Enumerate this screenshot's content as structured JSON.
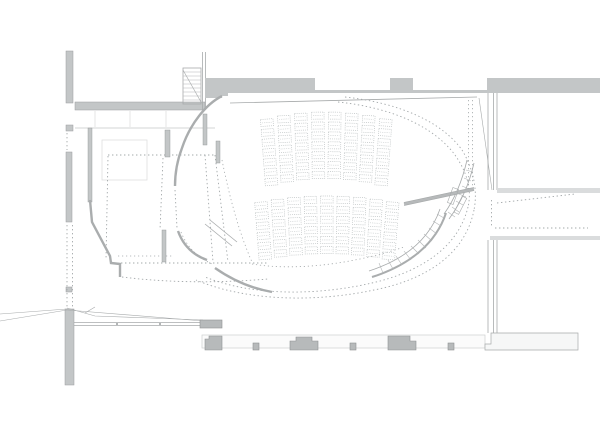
{
  "document": {
    "type": "architectural-floor-plan",
    "subject": "theater-auditorium-plan",
    "visible_text": []
  },
  "canvas": {
    "width": 600,
    "height": 425,
    "background": "#ffffff"
  },
  "colors": {
    "background": "#ffffff",
    "wall_fill": "#c3c6c7",
    "wall_stroke": "#9b9e9f",
    "pier_fill": "#b7babb",
    "pier_stroke": "#8f9293",
    "thick_curve": "#aaadae",
    "thin_line": "#a7aaab",
    "faint_line": "#d9dbdc",
    "dotted_line": "#a3a8aa",
    "seat_line": "#bcc1c2",
    "tread_line": "#b3b6b7",
    "light_band": "#dadcdd"
  },
  "seating": {
    "blocks": [
      {
        "name": "upper-seating-block",
        "rows": 7,
        "cols": 8,
        "seat_count": 56,
        "x0": 263,
        "y0": 112,
        "col_spacing": 16.3,
        "row_spacing": 9.9,
        "seat_w": 12.5,
        "seat_h": 7,
        "arc": 7,
        "fan_deg": 1.2
      },
      {
        "name": "lower-seating-block",
        "rows": 6,
        "cols": 9,
        "seat_count": 54,
        "x0": 257,
        "y0": 196,
        "col_spacing": 15.9,
        "row_spacing": 10.1,
        "seat_w": 12.5,
        "seat_h": 7,
        "arc": 6,
        "fan_deg": 1.1
      }
    ],
    "total_seats": 110
  },
  "features": [
    "exterior-wall-top-with-window-openings",
    "upper-left-stair",
    "curved-auditorium-wall",
    "curved-stair-right",
    "retractable-bleachers-dotted-left",
    "bottom-facade-wall-with-piers",
    "right-side-rooms",
    "lower-left-ramp-lines"
  ]
}
